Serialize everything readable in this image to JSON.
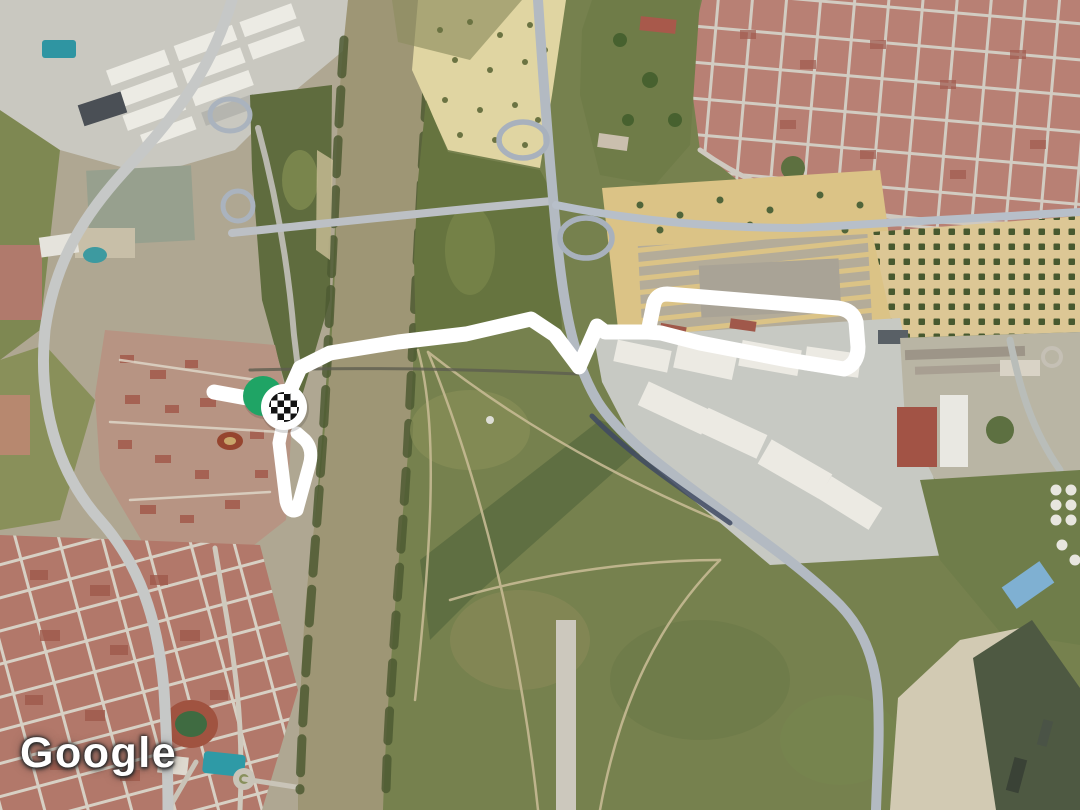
{
  "page": {
    "kind": "embedded-satellite-map-with-activity-route",
    "width": 1080,
    "height": 810
  },
  "attribution": {
    "logo_text": "Google"
  },
  "map": {
    "imagery": "satellite",
    "colors": {
      "terrain_base": "#76814e",
      "river": "#9e9675",
      "route": "#ffffff",
      "start_marker_green": "#1fa465",
      "finish_marker_bg": "#ffffff",
      "finish_checker": "#141414",
      "urban_red": "#b88074",
      "sandy_lot": "#dbc386",
      "road_gray": "#b7bfc9",
      "port_water": "#4e5942"
    }
  },
  "route": {
    "description": "white GPS track: west spur, river crossing, V-dip under highway, closed loop at east end",
    "main_path_d": "M214,392 L258,400 M284,404 L300,368 L330,353 L398,342 L466,334 L531,319 L555,335 L579,367 L597,326 L605,332 L648,332 L654,303 Q657,294 667,294 L838,308 Q853,310 856,322 L858,347 Q858,364 844,369 L788,360 L700,343 L661,333 L648,332",
    "branch_path_d": "M285,413 L279,443 L286,501 Q289,514 297,510 L309,466 Q314,450 305,440 L297,433",
    "stroke_width_main": 15,
    "stroke_width_branch": 13
  },
  "markers": {
    "start": {
      "label": "route start",
      "cx": 263,
      "cy": 396,
      "r": 20
    },
    "finish": {
      "label": "route finish (checkered flag)",
      "cx": 284,
      "cy": 407,
      "r": 23,
      "checker_r": 15,
      "checker_cell": 6.5
    }
  }
}
